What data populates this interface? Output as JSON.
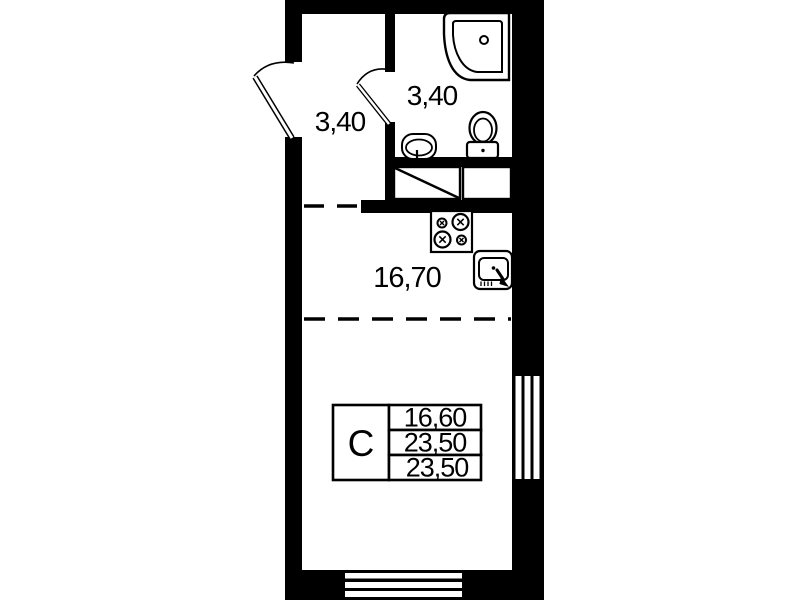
{
  "title": "Studio apartment floor plan",
  "colors": {
    "wall": "#000000",
    "background": "#ffffff",
    "ink": "#000000"
  },
  "rooms": {
    "hallway": {
      "area": "3,40"
    },
    "bathroom": {
      "area": "3,40"
    },
    "living_kitchen": {
      "area": "16,70"
    }
  },
  "stamp": {
    "type": "С",
    "rows": [
      "16,60",
      "23,50",
      "23,50"
    ]
  },
  "fixtures": [
    "corner-shower",
    "wash-basin",
    "toilet",
    "wardrobe",
    "closet",
    "stove",
    "kitchen-sink"
  ],
  "openings": [
    "entry-door",
    "bathroom-door",
    "window-right",
    "window-bottom"
  ]
}
